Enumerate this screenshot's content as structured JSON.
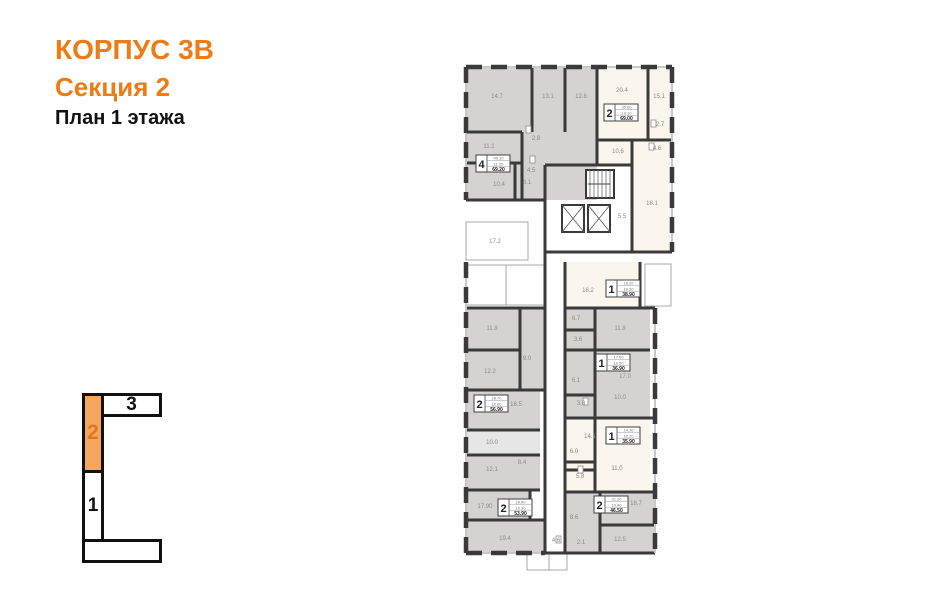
{
  "title": {
    "line1": "КОРПУС 3В",
    "line2": "Секция 2",
    "line3": "План 1 этажа"
  },
  "colors": {
    "accent": "#ee7c15",
    "key_active_fill": "#f4a55f",
    "key_active_text": "#dd7a1e",
    "wall": "#3a3a3a",
    "window_base": "#c8c8c8",
    "gray": "#d4d3d1",
    "light": "#e6e6e6",
    "cream": "#faf6ed",
    "white": "#ffffff",
    "label": "#8a8a8a"
  },
  "key": {
    "sections": [
      {
        "label": "3",
        "active": false
      },
      {
        "label": "2",
        "active": true
      },
      {
        "label": "1",
        "active": false
      },
      {
        "label": "",
        "active": false
      }
    ]
  },
  "plan": {
    "zones": [
      {
        "x": 466,
        "y": 67,
        "w": 131,
        "h": 133,
        "fill": "gray"
      },
      {
        "x": 597,
        "y": 67,
        "w": 75,
        "h": 98,
        "fill": "cream"
      },
      {
        "x": 597,
        "y": 140,
        "w": 75,
        "h": 25,
        "fill": "cream"
      },
      {
        "x": 632,
        "y": 165,
        "w": 40,
        "h": 87,
        "fill": "cream"
      },
      {
        "x": 466,
        "y": 308,
        "w": 79,
        "h": 82,
        "fill": "gray"
      },
      {
        "x": 466,
        "y": 390,
        "w": 74,
        "h": 40,
        "fill": "gray"
      },
      {
        "x": 466,
        "y": 430,
        "w": 74,
        "h": 25,
        "fill": "light"
      },
      {
        "x": 466,
        "y": 455,
        "w": 74,
        "h": 35,
        "fill": "gray"
      },
      {
        "x": 466,
        "y": 490,
        "w": 64,
        "h": 30,
        "fill": "gray"
      },
      {
        "x": 466,
        "y": 520,
        "w": 79,
        "h": 33,
        "fill": "gray"
      },
      {
        "x": 565,
        "y": 262,
        "w": 75,
        "h": 46,
        "fill": "cream"
      },
      {
        "x": 565,
        "y": 308,
        "w": 85,
        "h": 42,
        "fill": "gray"
      },
      {
        "x": 565,
        "y": 350,
        "w": 85,
        "h": 68,
        "fill": "gray"
      },
      {
        "x": 565,
        "y": 418,
        "w": 85,
        "h": 74,
        "fill": "cream"
      },
      {
        "x": 565,
        "y": 492,
        "w": 90,
        "h": 61,
        "fill": "gray"
      }
    ],
    "balconies": [
      {
        "x": 466,
        "y": 222,
        "w": 62,
        "h": 38
      },
      {
        "x": 466,
        "y": 265,
        "w": 40,
        "h": 40
      },
      {
        "x": 506,
        "y": 265,
        "w": 38,
        "h": 40
      },
      {
        "x": 645,
        "y": 264,
        "w": 26,
        "h": 42
      },
      {
        "x": 527,
        "y": 553,
        "w": 22,
        "h": 17
      },
      {
        "x": 549,
        "y": 553,
        "w": 18,
        "h": 17
      }
    ],
    "walls": [
      {
        "x1": 466,
        "y1": 200,
        "x2": 545,
        "y2": 200
      },
      {
        "x1": 545,
        "y1": 165,
        "x2": 545,
        "y2": 553
      },
      {
        "x1": 565,
        "y1": 262,
        "x2": 565,
        "y2": 553
      },
      {
        "x1": 545,
        "y1": 252,
        "x2": 672,
        "y2": 252
      },
      {
        "x1": 597,
        "y1": 67,
        "x2": 597,
        "y2": 140
      },
      {
        "x1": 532,
        "y1": 67,
        "x2": 532,
        "y2": 132
      },
      {
        "x1": 565,
        "y1": 67,
        "x2": 565,
        "y2": 132
      },
      {
        "x1": 466,
        "y1": 132,
        "x2": 522,
        "y2": 132
      },
      {
        "x1": 522,
        "y1": 132,
        "x2": 522,
        "y2": 200
      },
      {
        "x1": 466,
        "y1": 163,
        "x2": 522,
        "y2": 163
      },
      {
        "x1": 515,
        "y1": 163,
        "x2": 515,
        "y2": 200
      },
      {
        "x1": 648,
        "y1": 67,
        "x2": 648,
        "y2": 140
      },
      {
        "x1": 597,
        "y1": 140,
        "x2": 672,
        "y2": 140
      },
      {
        "x1": 632,
        "y1": 140,
        "x2": 632,
        "y2": 252
      },
      {
        "x1": 545,
        "y1": 165,
        "x2": 632,
        "y2": 165
      },
      {
        "x1": 597,
        "y1": 140,
        "x2": 597,
        "y2": 165
      },
      {
        "x1": 466,
        "y1": 308,
        "x2": 545,
        "y2": 308
      },
      {
        "x1": 520,
        "y1": 308,
        "x2": 520,
        "y2": 390
      },
      {
        "x1": 466,
        "y1": 350,
        "x2": 520,
        "y2": 350
      },
      {
        "x1": 466,
        "y1": 390,
        "x2": 545,
        "y2": 390
      },
      {
        "x1": 466,
        "y1": 430,
        "x2": 540,
        "y2": 430
      },
      {
        "x1": 466,
        "y1": 455,
        "x2": 540,
        "y2": 455
      },
      {
        "x1": 466,
        "y1": 490,
        "x2": 540,
        "y2": 490
      },
      {
        "x1": 530,
        "y1": 490,
        "x2": 530,
        "y2": 520
      },
      {
        "x1": 466,
        "y1": 520,
        "x2": 545,
        "y2": 520
      },
      {
        "x1": 565,
        "y1": 308,
        "x2": 655,
        "y2": 308
      },
      {
        "x1": 565,
        "y1": 350,
        "x2": 650,
        "y2": 350
      },
      {
        "x1": 595,
        "y1": 308,
        "x2": 595,
        "y2": 418
      },
      {
        "x1": 565,
        "y1": 418,
        "x2": 655,
        "y2": 418
      },
      {
        "x1": 595,
        "y1": 418,
        "x2": 595,
        "y2": 492
      },
      {
        "x1": 565,
        "y1": 492,
        "x2": 655,
        "y2": 492
      },
      {
        "x1": 600,
        "y1": 492,
        "x2": 600,
        "y2": 553
      },
      {
        "x1": 600,
        "y1": 525,
        "x2": 655,
        "y2": 525
      },
      {
        "x1": 640,
        "y1": 262,
        "x2": 640,
        "y2": 308
      },
      {
        "x1": 565,
        "y1": 330,
        "x2": 595,
        "y2": 330
      },
      {
        "x1": 565,
        "y1": 395,
        "x2": 595,
        "y2": 395
      },
      {
        "x1": 565,
        "y1": 462,
        "x2": 595,
        "y2": 462
      },
      {
        "x1": 565,
        "y1": 470,
        "x2": 595,
        "y2": 470
      },
      {
        "x1": 545,
        "y1": 553,
        "x2": 655,
        "y2": 553
      }
    ],
    "outer_walls": [
      {
        "x1": 466,
        "y1": 67,
        "x2": 672,
        "y2": 67
      },
      {
        "x1": 466,
        "y1": 67,
        "x2": 466,
        "y2": 200
      },
      {
        "x1": 672,
        "y1": 67,
        "x2": 672,
        "y2": 252
      },
      {
        "x1": 466,
        "y1": 262,
        "x2": 466,
        "y2": 553
      },
      {
        "x1": 466,
        "y1": 553,
        "x2": 545,
        "y2": 553
      },
      {
        "x1": 655,
        "y1": 308,
        "x2": 655,
        "y2": 553
      }
    ],
    "stairs": {
      "x": 586,
      "y": 170,
      "w": 28,
      "h": 28,
      "steps": 7
    },
    "elevators": [
      {
        "x": 562,
        "y": 205,
        "w": 22,
        "h": 27
      },
      {
        "x": 588,
        "y": 205,
        "w": 22,
        "h": 27
      }
    ],
    "fixtures": [
      {
        "x": 526,
        "y": 126,
        "w": 5,
        "h": 7
      },
      {
        "x": 530,
        "y": 156,
        "w": 5,
        "h": 7
      },
      {
        "x": 651,
        "y": 120,
        "w": 5,
        "h": 7
      },
      {
        "x": 649,
        "y": 143,
        "w": 5,
        "h": 7
      },
      {
        "x": 583,
        "y": 398,
        "w": 5,
        "h": 7
      },
      {
        "x": 578,
        "y": 466,
        "w": 5,
        "h": 7
      },
      {
        "x": 556,
        "y": 536,
        "w": 5,
        "h": 7
      }
    ],
    "room_labels": [
      {
        "t": "14.7",
        "x": 497,
        "y": 98
      },
      {
        "t": "13.1",
        "x": 548,
        "y": 98
      },
      {
        "t": "12.8",
        "x": 581,
        "y": 98
      },
      {
        "t": "11.1",
        "x": 489,
        "y": 148
      },
      {
        "t": "2.8",
        "x": 536,
        "y": 140
      },
      {
        "t": "4.5",
        "x": 531,
        "y": 172
      },
      {
        "t": "10.4",
        "x": 499,
        "y": 186
      },
      {
        "t": "6.1",
        "x": 527,
        "y": 184
      },
      {
        "t": "20.4",
        "x": 622,
        "y": 92
      },
      {
        "t": "15.1",
        "x": 659,
        "y": 98
      },
      {
        "t": "2.7",
        "x": 660,
        "y": 126
      },
      {
        "t": "4.6",
        "x": 657,
        "y": 150
      },
      {
        "t": "10.6",
        "x": 618,
        "y": 153
      },
      {
        "t": "18.1",
        "x": 652,
        "y": 205
      },
      {
        "t": "5.5",
        "x": 622,
        "y": 218
      },
      {
        "t": "17.2",
        "x": 495,
        "y": 243
      },
      {
        "t": "18.2",
        "x": 588,
        "y": 292
      },
      {
        "t": "6.7",
        "x": 576,
        "y": 320
      },
      {
        "t": "3.6",
        "x": 578,
        "y": 341
      },
      {
        "t": "11.8",
        "x": 620,
        "y": 330
      },
      {
        "t": "11.8",
        "x": 492,
        "y": 330
      },
      {
        "t": "12.2",
        "x": 490,
        "y": 373
      },
      {
        "t": "9.0",
        "x": 527,
        "y": 360
      },
      {
        "t": "17.0",
        "x": 625,
        "y": 378
      },
      {
        "t": "6.1",
        "x": 576,
        "y": 382
      },
      {
        "t": "3.8",
        "x": 581,
        "y": 405
      },
      {
        "t": "10.0",
        "x": 620,
        "y": 399
      },
      {
        "t": "16.5",
        "x": 516,
        "y": 406
      },
      {
        "t": "10.0",
        "x": 492,
        "y": 444
      },
      {
        "t": "14.1",
        "x": 590,
        "y": 438
      },
      {
        "t": "6.0",
        "x": 574,
        "y": 453
      },
      {
        "t": "5.8",
        "x": 580,
        "y": 478
      },
      {
        "t": "11.0",
        "x": 617,
        "y": 470
      },
      {
        "t": "12.1",
        "x": 492,
        "y": 471
      },
      {
        "t": "8.4",
        "x": 522,
        "y": 464
      },
      {
        "t": "17.90",
        "x": 485,
        "y": 508
      },
      {
        "t": "18.7",
        "x": 636,
        "y": 505
      },
      {
        "t": "8.6",
        "x": 574,
        "y": 519
      },
      {
        "t": "19.4",
        "x": 505,
        "y": 540
      },
      {
        "t": "12.5",
        "x": 620,
        "y": 541
      },
      {
        "t": "4.6",
        "x": 556,
        "y": 542
      },
      {
        "t": "2.1",
        "x": 581,
        "y": 544
      }
    ],
    "info_boxes": [
      {
        "x": 476,
        "y": 155,
        "rooms": "4",
        "sub1": "40.10",
        "sub2": "11.20",
        "total": "69.20"
      },
      {
        "x": 604,
        "y": 104,
        "rooms": "2",
        "sub1": "35.60",
        "sub2": "19.10",
        "total": "69.00"
      },
      {
        "x": 606,
        "y": 280,
        "rooms": "1",
        "sub1": "18.20",
        "sub2": "10.30",
        "total": "38.90"
      },
      {
        "x": 596,
        "y": 354,
        "rooms": "1",
        "sub1": "17.00",
        "sub2": "10.50",
        "total": "36.90"
      },
      {
        "x": 474,
        "y": 395,
        "rooms": "2",
        "sub1": "28.70",
        "sub2": "10.60",
        "total": "56.90"
      },
      {
        "x": 606,
        "y": 427,
        "rooms": "1",
        "sub1": "14.10",
        "sub2": "10.20",
        "total": "35.90"
      },
      {
        "x": 498,
        "y": 499,
        "rooms": "2",
        "sub1": "29.90",
        "sub2": "10.30",
        "total": "53.90"
      },
      {
        "x": 594,
        "y": 496,
        "rooms": "2",
        "sub1": "31.20",
        "sub2": "10.40",
        "total": "46.50"
      }
    ]
  }
}
